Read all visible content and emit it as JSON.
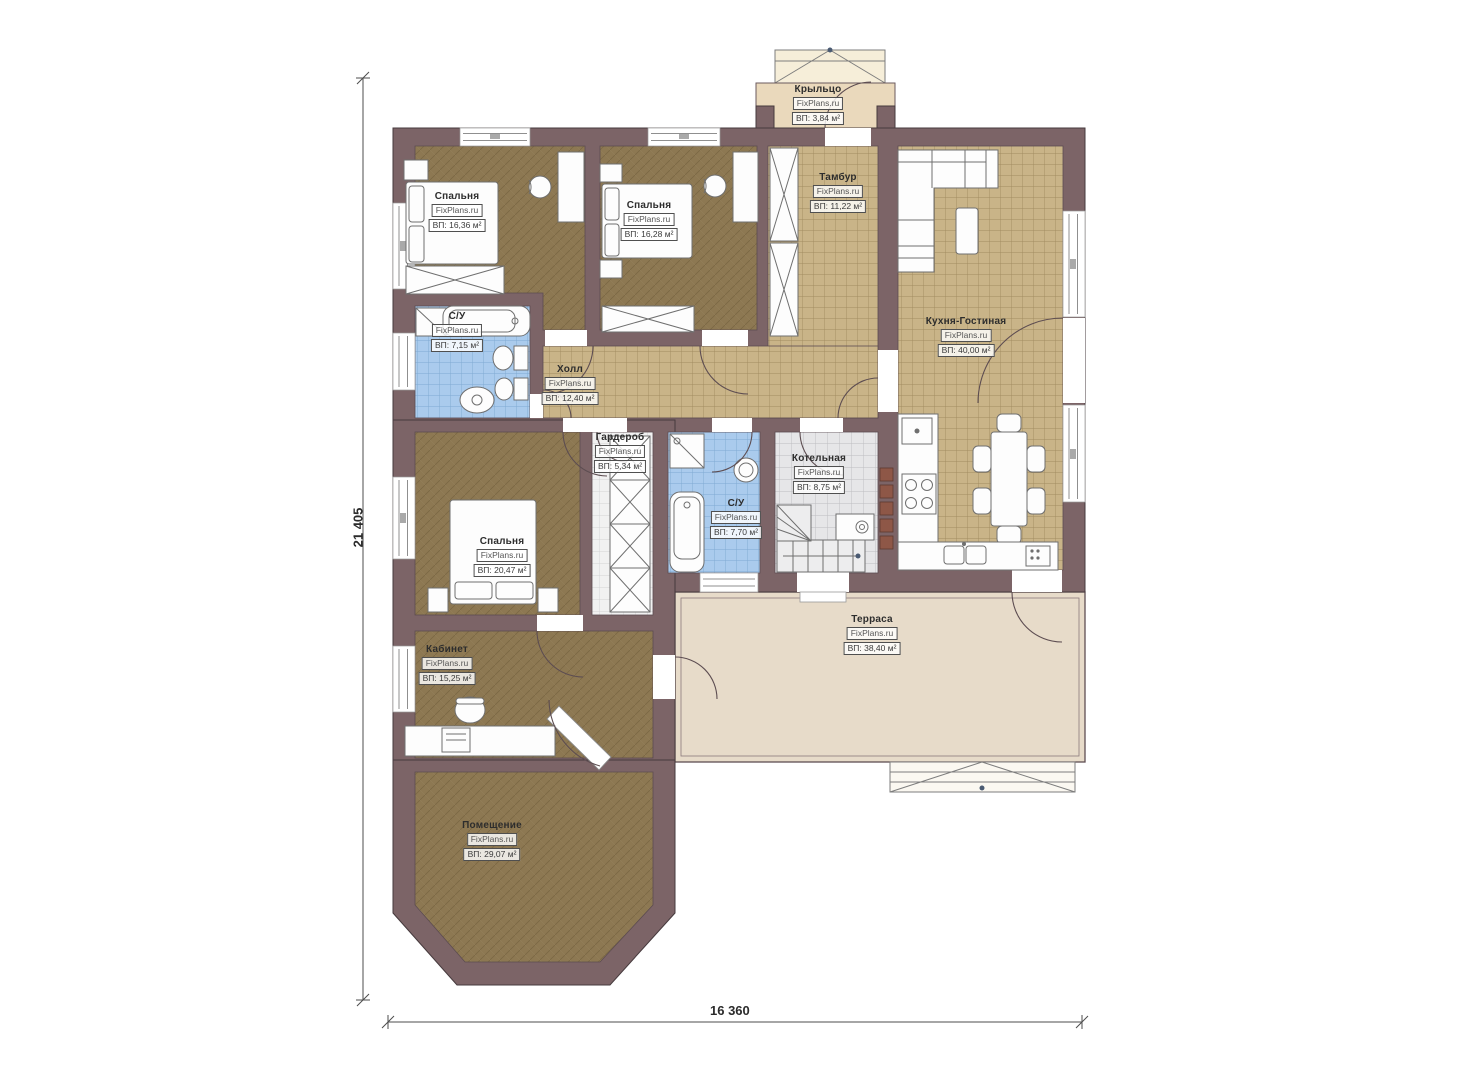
{
  "plan_title": "Floor plan",
  "brand": "FixPlans.ru",
  "rooms": {
    "porch": {
      "name": "Крыльцо",
      "brand": "FixPlans.ru",
      "area": "ВП: 3,84 м²"
    },
    "vestibule": {
      "name": "Тамбур",
      "brand": "FixPlans.ru",
      "area": "ВП: 11,22 м²"
    },
    "bedroom1": {
      "name": "Спальня",
      "brand": "FixPlans.ru",
      "area": "ВП: 16,36 м²"
    },
    "bedroom2": {
      "name": "Спальня",
      "brand": "FixPlans.ru",
      "area": "ВП: 16,28 м²"
    },
    "kitchen_living": {
      "name": "Кухня-Гостиная",
      "brand": "FixPlans.ru",
      "area": "ВП: 40,00 м²"
    },
    "bathroom1": {
      "name": "С/У",
      "brand": "FixPlans.ru",
      "area": "ВП: 7,15 м²"
    },
    "hall": {
      "name": "Холл",
      "brand": "FixPlans.ru",
      "area": "ВП: 12,40 м²"
    },
    "wardrobe": {
      "name": "Гардероб",
      "brand": "FixPlans.ru",
      "area": "ВП: 5,34 м²"
    },
    "bathroom2": {
      "name": "С/У",
      "brand": "FixPlans.ru",
      "area": "ВП: 7,70 м²"
    },
    "boiler_room": {
      "name": "Котельная",
      "brand": "FixPlans.ru",
      "area": "ВП: 8,75 м²"
    },
    "bedroom3": {
      "name": "Спальня",
      "brand": "FixPlans.ru",
      "area": "ВП: 20,47 м²"
    },
    "terrace": {
      "name": "Терраса",
      "brand": "FixPlans.ru",
      "area": "ВП: 38,40 м²"
    },
    "office": {
      "name": "Кабинет",
      "brand": "FixPlans.ru",
      "area": "ВП: 15,25 м²"
    },
    "utility_room": {
      "name": "Помещение",
      "brand": "FixPlans.ru",
      "area": "ВП: 29,07 м²"
    }
  },
  "dimensions": {
    "height": "21 405",
    "width": "16 360"
  },
  "colors": {
    "wall": "#7c6467",
    "floor_wood": "#8d7852",
    "tile_beige": "#c9b488",
    "tile_blue": "#aacbed",
    "tile_grey": "#e6e6e8",
    "terrace": "#e7dbc9",
    "porch": "#ead9bc"
  }
}
